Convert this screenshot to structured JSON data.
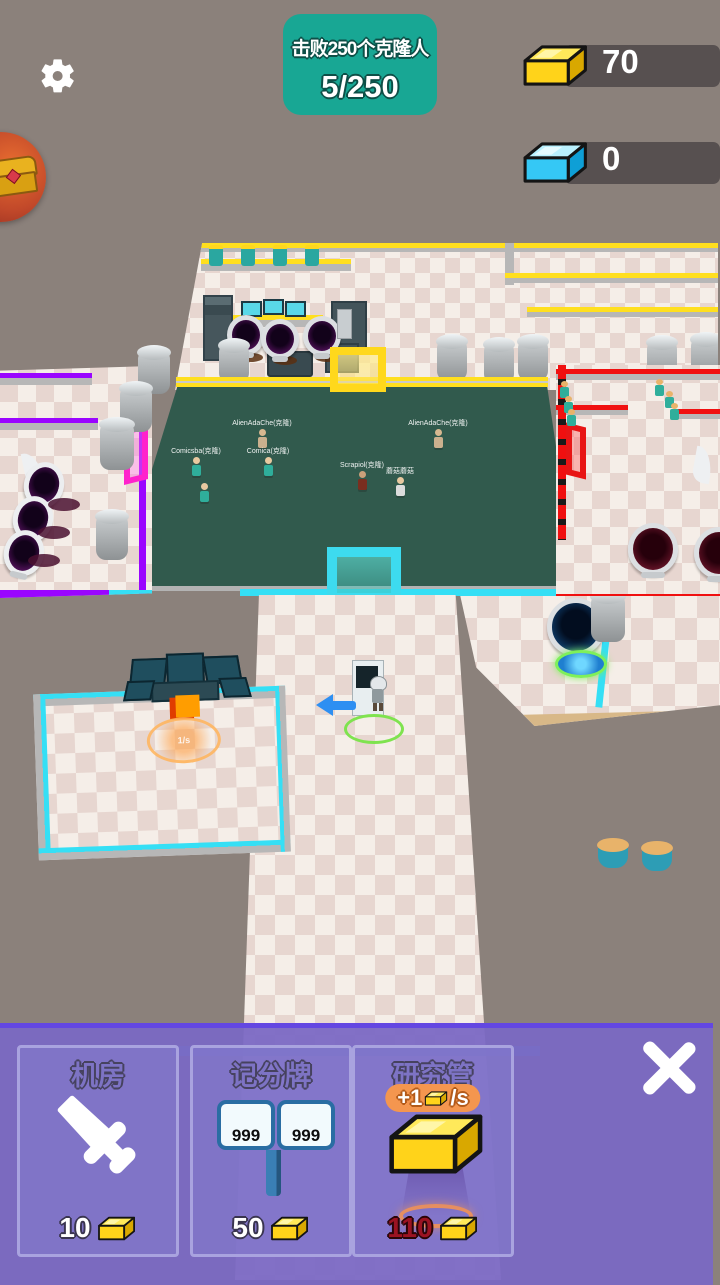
{
  "hud": {
    "objective": {
      "line1": "击败250个克隆人",
      "line2": "5/250"
    },
    "resources": {
      "gold": "70",
      "blue": "0"
    }
  },
  "scene": {
    "clones": [
      {
        "name": "Comicsba(克隆)"
      },
      {
        "name": "AlienAdaChe(克隆)"
      },
      {
        "name": "Comica(克隆)"
      },
      {
        "name": "Scrapiol(克隆)"
      },
      {
        "name": "蘑菇蘑菇"
      },
      {
        "name": "AlienAdaChe(克隆)"
      }
    ],
    "fire_rate": "1/s"
  },
  "shop": {
    "cards": [
      {
        "title": "机房",
        "cost": "10"
      },
      {
        "title": "记分牌",
        "cost": "50",
        "score_left": "999",
        "score_right": "999"
      },
      {
        "title": "研究管",
        "cost": "110",
        "badge_value": "+1",
        "badge_unit": "/s"
      }
    ]
  },
  "colors": {
    "accent_teal": "#18a794",
    "gold": "#ffd31a",
    "blue_resource": "#35c8f5",
    "panel_purple": "#7b68c4",
    "cost_red": "#9b1322"
  }
}
